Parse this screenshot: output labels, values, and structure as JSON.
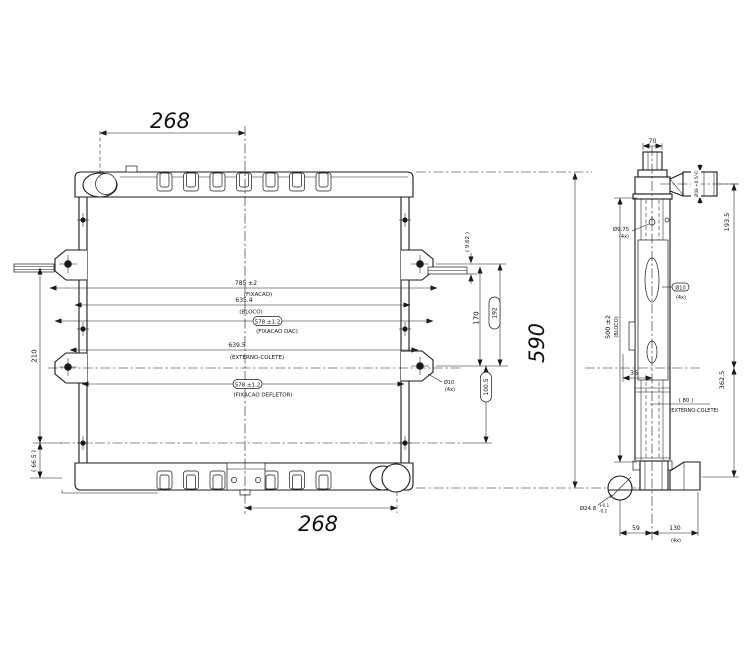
{
  "drawing": {
    "front_view": {
      "dim_top_width": "268",
      "dim_bottom_width": "268",
      "dim_total_height": "590",
      "dim_left_span": "210",
      "dim_left_foot": "( 66.5 )",
      "dim_plate_offset": "( 9.62 )",
      "dim_bracket_span": "170",
      "pill_upper": "192",
      "pill_lower": "100.5",
      "hole_note_value": "Ø10",
      "hole_note_qty": "(4x)",
      "width_dims": [
        {
          "value": "785 ±2",
          "note": "(FIXACAO)"
        },
        {
          "value": "635.4",
          "note": "(BLOCO)"
        },
        {
          "value": "578 ±1.2",
          "note": "(FIXACAO DAC)"
        },
        {
          "value": "639.5",
          "note": "(EXTERNO-COLETE)"
        },
        {
          "value": "578 ±1.2",
          "note": "(FIXACAO DEFLETOR)"
        }
      ]
    },
    "side_view": {
      "dim_neck": "70",
      "dim_inlet": "Ø48 +0.5/-0",
      "hole_value": "Ø9.75",
      "hole_qty": "(4x)",
      "dim_upper": "193.5",
      "dim_lower": "362.5",
      "dim_core": "500 ±2",
      "dim_core_note": "(BLOCO)",
      "dim_tab": "36",
      "fan_pill_value": "Ø10",
      "fan_pill_qty": "(4x)",
      "ref_colete": "( 80 )",
      "ref_colete_note": "(EXTERNO-COLETE)",
      "outlet_value": "Ø24.8",
      "outlet_tol_plus": "+0.1",
      "outlet_tol_minus": "-0.2",
      "dim_foot_a": "59",
      "dim_foot_b": "130",
      "dim_foot_qty": "(4x)"
    }
  }
}
